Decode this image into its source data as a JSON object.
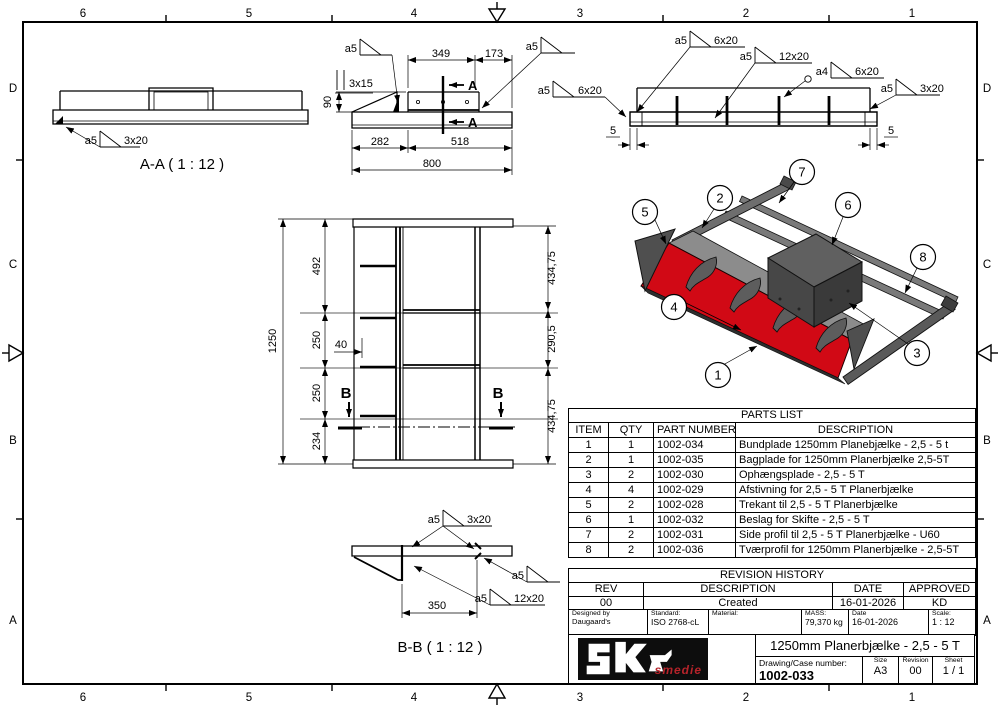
{
  "frame": {
    "top_labels": [
      "6",
      "5",
      "4",
      "3",
      "2",
      "1"
    ],
    "bottom_labels": [
      "6",
      "5",
      "4",
      "3",
      "2",
      "1"
    ],
    "left_labels": [
      "D",
      "C",
      "B",
      "A"
    ],
    "right_labels": [
      "D",
      "C",
      "B",
      "A"
    ]
  },
  "view_aa": {
    "title": "A-A ( 1 : 12 )",
    "weld": {
      "a": "a5",
      "size": "3x20"
    }
  },
  "view_top": {
    "section_label": "A",
    "weld_left": {
      "a": "a5"
    },
    "weld_right": {
      "a": "a5"
    },
    "dims": {
      "d349": "349",
      "d173": "173",
      "d90": "90",
      "d3x15": "3x15",
      "d282": "282",
      "d518": "518",
      "d800": "800"
    }
  },
  "view_rear": {
    "welds": {
      "w1": {
        "a": "a5",
        "size": "6x20"
      },
      "w2": {
        "a": "a5",
        "size": "12x20"
      },
      "w3": {
        "a": "a4",
        "size": "6x20"
      },
      "w4": {
        "a": "a5",
        "size": "3x20"
      },
      "w5": {
        "a": "a5",
        "size": "6x20"
      }
    },
    "dims": {
      "d5l": "5",
      "d5r": "5"
    }
  },
  "view_front": {
    "section_label": "B",
    "dims": {
      "d1250": "1250",
      "d492": "492",
      "d250a": "250",
      "d250b": "250",
      "d234": "234",
      "d40": "40",
      "d434a": "434,75",
      "d290": "290,5",
      "d434b": "434,75"
    }
  },
  "view_bb": {
    "title": "B-B ( 1 : 12 )",
    "dims": {
      "d350": "350"
    },
    "welds": {
      "w1": {
        "a": "a5",
        "size": "3x20"
      },
      "w2": {
        "a": "a5"
      },
      "w3": {
        "a": "a5",
        "size": "12x20"
      }
    }
  },
  "iso": {
    "balloons": [
      "1",
      "2",
      "3",
      "4",
      "5",
      "6",
      "7",
      "8"
    ],
    "blade_color": "#d10915"
  },
  "parts_list": {
    "title": "PARTS LIST",
    "headers": [
      "ITEM",
      "QTY",
      "PART NUMBER",
      "DESCRIPTION"
    ],
    "rows": [
      {
        "item": "1",
        "qty": "1",
        "part": "1002-034",
        "desc": "Bundplade 1250mm Planebjælke - 2,5 - 5 t"
      },
      {
        "item": "2",
        "qty": "1",
        "part": "1002-035",
        "desc": "Bagplade for 1250mm Planerbjælke 2,5-5T"
      },
      {
        "item": "3",
        "qty": "2",
        "part": "1002-030",
        "desc": "Ophængsplade - 2,5 - 5 T"
      },
      {
        "item": "4",
        "qty": "4",
        "part": "1002-029",
        "desc": "Afstivning for 2,5 - 5 T Planerbjælke"
      },
      {
        "item": "5",
        "qty": "2",
        "part": "1002-028",
        "desc": "Trekant til 2,5 - 5 T Planerbjælke"
      },
      {
        "item": "6",
        "qty": "1",
        "part": "1002-032",
        "desc": "Beslag for Skifte - 2,5 - 5 T"
      },
      {
        "item": "7",
        "qty": "2",
        "part": "1002-031",
        "desc": "Side profil til 2,5 - 5 T Planerbjælke - U60"
      },
      {
        "item": "8",
        "qty": "2",
        "part": "1002-036",
        "desc": "Tværprofil for 1250mm Planerbjælke - 2,5-5T"
      }
    ]
  },
  "revision_history": {
    "title": "REVISION HISTORY",
    "headers": [
      "REV",
      "DESCRIPTION",
      "DATE",
      "APPROVED"
    ],
    "rows": [
      {
        "rev": "00",
        "description": "Created",
        "date": "16-01-2026",
        "approved": "KD"
      }
    ]
  },
  "title_block": {
    "designed_by_label": "Designed by",
    "designed_by": "Daugaard's",
    "standard_label": "Standard:",
    "standard": "ISO 2768-cL",
    "material_label": "Material:",
    "material": "",
    "mass_label": "MASS:",
    "mass": "79,370 kg",
    "date_label": "Date",
    "date": "16-01-2026",
    "scale_label": "Scale:",
    "scale": "1 : 12",
    "title": "1250mm Planerbjælke - 2,5 - 5 T",
    "drawing_number_label": "Drawing/Case number:",
    "drawing_number": "1002-033",
    "size_label": "Size",
    "size": "A3",
    "revision_label": "Revision",
    "revision": "00",
    "sheet_label": "Sheet",
    "sheet": "1 / 1",
    "logo_text": "smedie"
  }
}
